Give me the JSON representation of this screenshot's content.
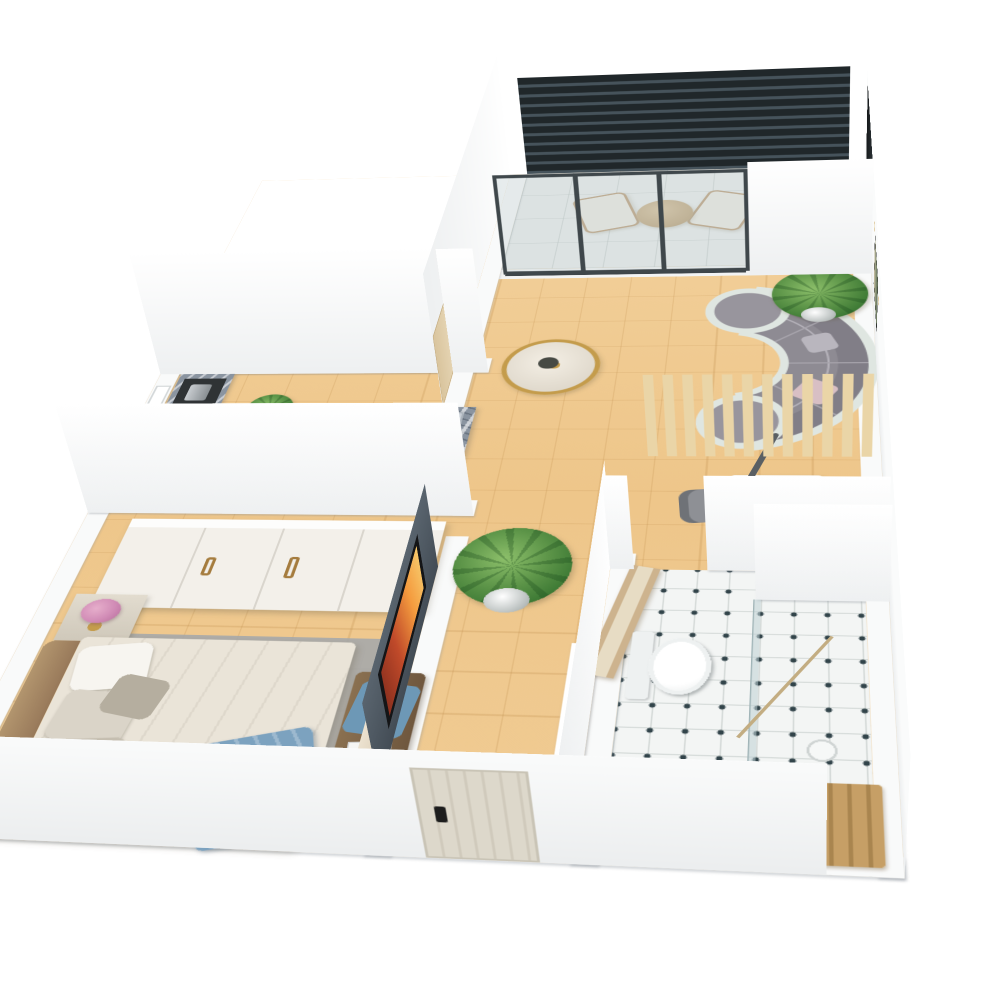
{
  "meta": {
    "kind": "3d-isometric-floor-plan-render",
    "view": "three-quarter top-down, camera above south-west",
    "background": "#ffffff",
    "visible_text": "none"
  },
  "palette": {
    "wall": "#f8f9f9",
    "wall_shade": "#eef0f1",
    "wood_floor": "#f0cb93",
    "balcony_tile": "#e9ebe9",
    "bath_tile": "#f3f5f4",
    "bath_dot": "#32444a",
    "louver_dark": "#20272a",
    "glass_frame": "#3f474b",
    "sofa_gray": "#8e8b93",
    "sofa_frame": "#dfe6e1",
    "table_gold": "#c49c4c",
    "granite": "#8a94a0",
    "cabinet_white": "#efece5",
    "oven_wood": "#b98a4e",
    "slat_wood": "#ead5a7",
    "bedding": "#eae4d8",
    "throw_blue": "#7ca2bf",
    "bench_brown": "#7d6448",
    "rug_gray": "#a2a7ab",
    "flowers_pink": "#d18cb6",
    "plant_green": "#5c9448",
    "entry_door": "#ddd8cb",
    "tv_screen_glow": "#f49b3e"
  },
  "rooms": [
    {
      "id": "balcony",
      "label": "Balcony",
      "items": [
        "dark louver privacy screen",
        "lounge chair",
        "lounge chair",
        "round rattan side table",
        "potted palm",
        "wall-mounted dark screen",
        "sliding glass door"
      ]
    },
    {
      "id": "living-room",
      "label": "Living room",
      "items": [
        "curved gray sectional sofa",
        "accent pillows",
        "round gold-rim marble coffee table",
        "decor vase",
        "potted palm",
        "framed wall artwork",
        "wall sconce",
        "wall sconce",
        "interior door"
      ]
    },
    {
      "id": "kitchen",
      "label": "Kitchen",
      "items": [
        "tall granite unit with coffee machine",
        "black cooktop",
        "built-in appliance",
        "granite island",
        "double sink with faucet",
        "wood-front oven",
        "white base cabinets",
        "herb plant",
        "window"
      ]
    },
    {
      "id": "bedroom",
      "label": "Bedroom",
      "items": [
        "four-door white wardrobe with brass handles",
        "double bed with beige bedding",
        "pillows",
        "blue throw blanket",
        "brown headboard",
        "nightstand",
        "pink bouquet in vase",
        "wooden bench",
        "blue cloth",
        "open magazine",
        "gray area rug",
        "media wall with TV",
        "side console",
        "small potted plant"
      ]
    },
    {
      "id": "hallway",
      "label": "Hallway",
      "items": [
        "potted palm",
        "white ladder rack",
        "entry door with black lock",
        "open wooden bathroom door"
      ]
    },
    {
      "id": "work-nook",
      "label": "Work nook",
      "items": [
        "timber slat partition",
        "white desk",
        "gray chair",
        "gray chair",
        "black pendant lights",
        "floor lamp"
      ]
    },
    {
      "id": "bathroom",
      "label": "Bathroom",
      "items": [
        "toilet",
        "glass shower screen",
        "teak duckboard",
        "floor drain",
        "dotted mosaic tile floor",
        "wall niche shelf"
      ]
    }
  ]
}
